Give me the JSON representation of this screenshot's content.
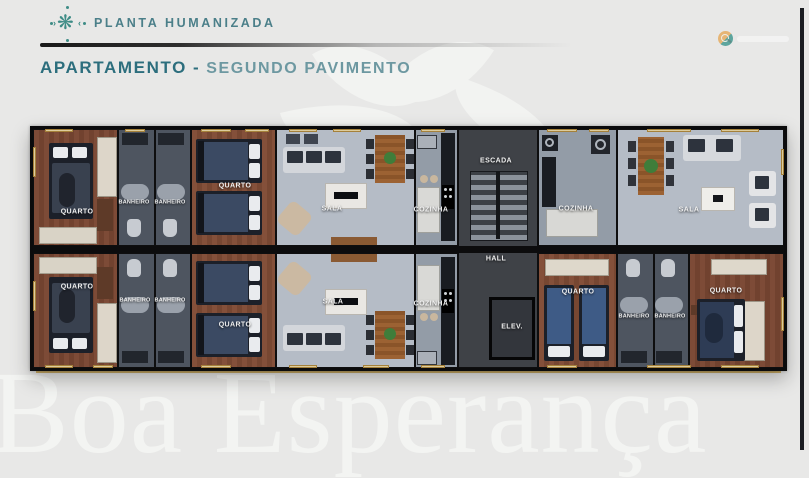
{
  "header": {
    "logo_label": "PLANTA HUMANIZADA",
    "title": "APARTAMENTO",
    "separator": "-",
    "subtitle": "SEGUNDO PAVIMENTO"
  },
  "watermark": {
    "text": "Boa Esperança"
  },
  "plan": {
    "labels": [
      {
        "id": "quarto-top-left",
        "label": "QUARTO"
      },
      {
        "id": "banheiro-top-1",
        "label": "BANHEIRO"
      },
      {
        "id": "banheiro-top-2",
        "label": "BANHEIRO"
      },
      {
        "id": "quarto-top-2",
        "label": "QUARTO"
      },
      {
        "id": "sala-top-left",
        "label": "SALA"
      },
      {
        "id": "cozinha-top-left",
        "label": "COZINHA"
      },
      {
        "id": "escada",
        "label": "ESCADA"
      },
      {
        "id": "cozinha-top-right",
        "label": "COZINHA"
      },
      {
        "id": "sala-top-right",
        "label": "SALA"
      },
      {
        "id": "quarto-bottom-left",
        "label": "QUARTO"
      },
      {
        "id": "banheiro-bottom-1",
        "label": "BANHEIRO"
      },
      {
        "id": "banheiro-bottom-2",
        "label": "BANHEIRO"
      },
      {
        "id": "quarto-bottom-2",
        "label": "QUARTO"
      },
      {
        "id": "sala-bottom",
        "label": "SALA"
      },
      {
        "id": "cozinha-bottom",
        "label": "COZINHA"
      },
      {
        "id": "hall",
        "label": "HALL"
      },
      {
        "id": "elevador",
        "label": "ELEV."
      },
      {
        "id": "quarto-bottom-right-1",
        "label": "QUARTO"
      },
      {
        "id": "banheiro-bottom-right-1",
        "label": "BANHEIRO"
      },
      {
        "id": "banheiro-bottom-right-2",
        "label": "BANHEIRO"
      },
      {
        "id": "quarto-bottom-right-2",
        "label": "QUARTO"
      }
    ]
  },
  "colors": {
    "background": "#e8e8e7",
    "accent_teal": "#2c6e7d",
    "subtitle_teal": "#6d98a1",
    "wall": "#0b0b0c",
    "wood_floor": "#7d4b37",
    "bath_floor": "#4e5560",
    "sala_floor": "#b5bcc6",
    "cozinha_floor": "#939ca7",
    "core_floor": "#43464c",
    "window_gold": "#c9a24a",
    "watermark_text": "#f3f4f2"
  }
}
